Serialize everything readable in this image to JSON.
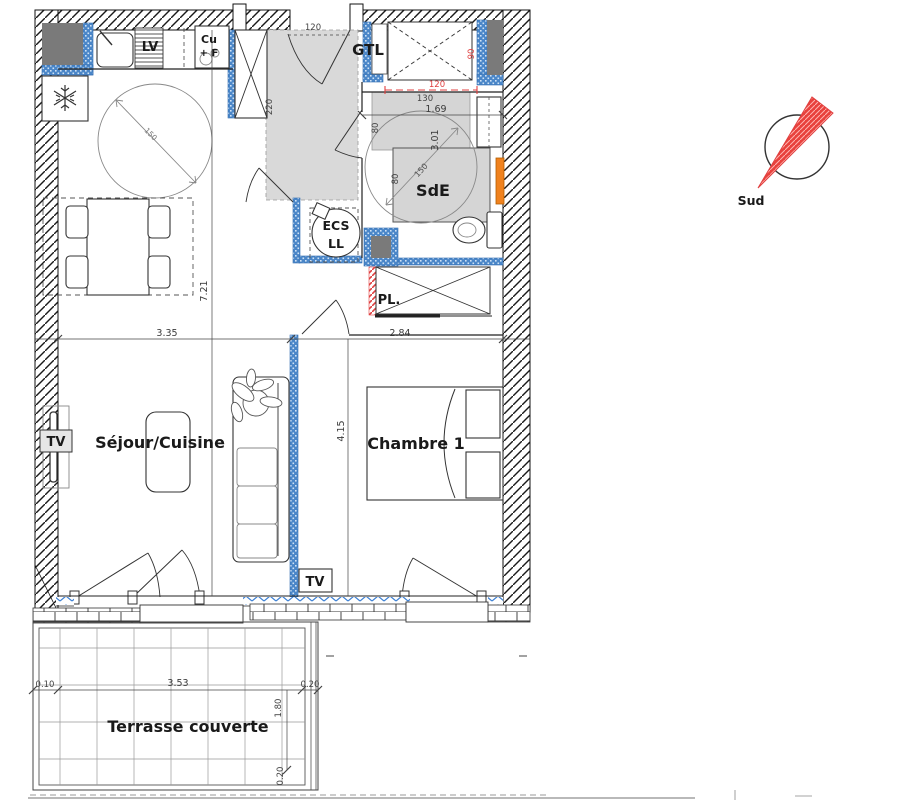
{
  "rooms": {
    "sejour": "Séjour/Cuisine",
    "chambre": "Chambre 1",
    "sde": "SdE",
    "terrasse": "Terrasse couverte"
  },
  "labels": {
    "gtl": "GTL",
    "ecs": "ECS",
    "ll": "LL",
    "pl": "PL.",
    "lv": "LV",
    "cooktop_top": "Cu",
    "cooktop_bottom": "+ F",
    "tv_sejour": "TV",
    "tv_chambre": "TV"
  },
  "compass": {
    "south_label": "Sud"
  },
  "dims": {
    "entry_door_width": "120",
    "entry_depth": "220",
    "shower_width_red": "120",
    "shower_depth_red": "90",
    "vanity_width": "130",
    "sde_width": "1.69",
    "sde_length": "3.01",
    "shower_side_top": "80",
    "shower_side_bottom": "80",
    "turning_circle_sde": "150",
    "turning_circle_kitchen": "150",
    "sejour_width": "3.35",
    "chambre_width": "2.84",
    "apartment_depth": "7.21",
    "chambre_depth": "4.15",
    "terrasse_offset_left": "0.10",
    "terrasse_width": "3.53",
    "terrasse_offset_right": "0.20",
    "terrasse_depth": "1.80",
    "terrasse_edge": "0.20"
  },
  "colors": {
    "insulation_blue": "#4a86c8",
    "glazing_blue": "#3b7fd4",
    "dim_red": "#e04040",
    "floor_gray": "#d9d9d9",
    "shower_gray": "#d5d5d5",
    "radiator_orange": "#f0821e",
    "duct_gray": "#7a7a7a"
  }
}
